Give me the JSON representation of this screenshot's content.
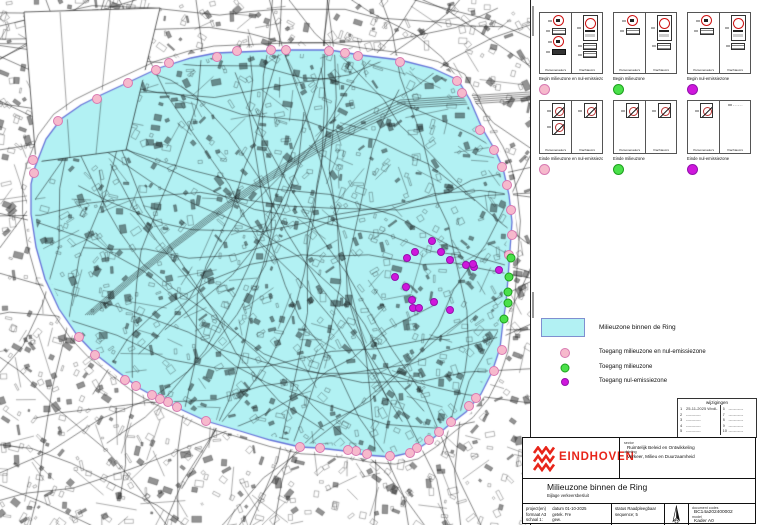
{
  "colors": {
    "zone_fill": "#b2f1f3",
    "zone_border": "#6673d9",
    "pink_fill": "#f6b9cc",
    "pink_stroke": "#d87ab2",
    "green_fill": "#4ae04a",
    "green_stroke": "#1da01d",
    "magenta_fill": "#cf17dc",
    "magenta_stroke": "#9311ad",
    "brand_red": "#e8251a"
  },
  "map": {
    "zone_polygon": [
      [
        240,
        52
      ],
      [
        290,
        50
      ],
      [
        330,
        50
      ],
      [
        360,
        55
      ],
      [
        400,
        60
      ],
      [
        432,
        68
      ],
      [
        458,
        80
      ],
      [
        470,
        100
      ],
      [
        482,
        128
      ],
      [
        495,
        150
      ],
      [
        503,
        168
      ],
      [
        509,
        195
      ],
      [
        512,
        222
      ],
      [
        510,
        250
      ],
      [
        508,
        278
      ],
      [
        506,
        303
      ],
      [
        503,
        322
      ],
      [
        500,
        348
      ],
      [
        492,
        372
      ],
      [
        481,
        394
      ],
      [
        466,
        412
      ],
      [
        449,
        425
      ],
      [
        431,
        440
      ],
      [
        413,
        452
      ],
      [
        391,
        457
      ],
      [
        366,
        455
      ],
      [
        345,
        451
      ],
      [
        319,
        448
      ],
      [
        300,
        447
      ],
      [
        270,
        440
      ],
      [
        240,
        431
      ],
      [
        206,
        421
      ],
      [
        178,
        408
      ],
      [
        159,
        399
      ],
      [
        139,
        388
      ],
      [
        117,
        371
      ],
      [
        94,
        353
      ],
      [
        77,
        335
      ],
      [
        59,
        309
      ],
      [
        45,
        279
      ],
      [
        36,
        247
      ],
      [
        31,
        214
      ],
      [
        31,
        184
      ],
      [
        35,
        167
      ],
      [
        46,
        139
      ],
      [
        61,
        119
      ],
      [
        81,
        105
      ],
      [
        101,
        95
      ],
      [
        129,
        82
      ],
      [
        159,
        68
      ],
      [
        191,
        58
      ],
      [
        216,
        53
      ]
    ],
    "access_points": {
      "pink": [
        [
          237,
          51
        ],
        [
          271,
          50
        ],
        [
          286,
          50
        ],
        [
          329,
          51
        ],
        [
          345,
          53
        ],
        [
          358,
          56
        ],
        [
          400,
          62
        ],
        [
          457,
          81
        ],
        [
          462,
          93
        ],
        [
          480,
          130
        ],
        [
          494,
          150
        ],
        [
          502,
          167
        ],
        [
          507,
          185
        ],
        [
          511,
          210
        ],
        [
          512,
          235
        ],
        [
          509,
          255
        ],
        [
          502,
          350
        ],
        [
          494,
          371
        ],
        [
          476,
          398
        ],
        [
          469,
          406
        ],
        [
          451,
          422
        ],
        [
          439,
          432
        ],
        [
          429,
          440
        ],
        [
          417,
          448
        ],
        [
          410,
          453
        ],
        [
          390,
          456
        ],
        [
          367,
          454
        ],
        [
          356,
          451
        ],
        [
          348,
          450
        ],
        [
          320,
          448
        ],
        [
          300,
          447
        ],
        [
          206,
          421
        ],
        [
          177,
          407
        ],
        [
          168,
          402
        ],
        [
          160,
          399
        ],
        [
          152,
          395
        ],
        [
          136,
          386
        ],
        [
          125,
          380
        ],
        [
          95,
          355
        ],
        [
          79,
          337
        ],
        [
          58,
          121
        ],
        [
          33,
          160
        ],
        [
          34,
          173
        ],
        [
          97,
          99
        ],
        [
          128,
          83
        ],
        [
          156,
          70
        ],
        [
          169,
          63
        ],
        [
          217,
          57
        ]
      ],
      "green": [
        [
          511,
          258
        ],
        [
          509,
          277
        ],
        [
          508,
          292
        ],
        [
          508,
          303
        ],
        [
          504,
          319
        ]
      ],
      "magenta": [
        [
          432,
          241
        ],
        [
          441,
          252
        ],
        [
          415,
          252
        ],
        [
          407,
          258
        ],
        [
          450,
          260
        ],
        [
          466,
          265
        ],
        [
          474,
          267
        ],
        [
          395,
          277
        ],
        [
          406,
          287
        ],
        [
          412,
          300
        ],
        [
          413,
          308
        ],
        [
          419,
          308
        ],
        [
          434,
          302
        ],
        [
          450,
          310
        ],
        [
          499,
          270
        ],
        [
          473,
          264
        ]
      ]
    }
  },
  "signs": {
    "rows": [
      {
        "boxes": [
          {
            "caption": "Begin milieuzone en nul-emissiezone",
            "dot": "pink",
            "cells": [
              {
                "caption": "Personenauto's",
                "glyphs": [
                  "circle",
                  "plaque",
                  "circle",
                  "plaque-dark"
                ]
              },
              {
                "caption": "Vrachtauto's",
                "glyphs": [
                  "zone",
                  "plaque",
                  "plaque"
                ]
              }
            ]
          },
          {
            "caption": "Begin milieuzone",
            "dot": "green",
            "cells": [
              {
                "caption": "Personenauto's",
                "glyphs": [
                  "circle",
                  "plaque"
                ]
              },
              {
                "caption": "Vrachtauto's",
                "glyphs": [
                  "zone",
                  "plaque"
                ]
              }
            ]
          },
          {
            "caption": "Begin nul-emissiezone",
            "dot": "magenta",
            "cells": [
              {
                "caption": "Personenauto's",
                "glyphs": [
                  "circle",
                  "plaque"
                ]
              },
              {
                "caption": "Vrachtauto's",
                "glyphs": [
                  "zone",
                  "plaque"
                ]
              }
            ]
          }
        ]
      },
      {
        "boxes": [
          {
            "caption": "Einde milieuzone en nul-emissiezone",
            "dot": "pink",
            "cells": [
              {
                "caption": "Personenauto's",
                "glyphs": [
                  "slash",
                  "slash"
                ]
              },
              {
                "caption": "Vrachtauto's",
                "glyphs": [
                  "slash"
                ]
              }
            ]
          },
          {
            "caption": "Einde milieuzone",
            "dot": "green",
            "cells": [
              {
                "caption": "Personenauto's",
                "glyphs": [
                  "slash"
                ]
              },
              {
                "caption": "Vrachtauto's",
                "glyphs": [
                  "slash"
                ]
              }
            ]
          },
          {
            "caption": "Einde nul-emissiezone",
            "dot": "magenta",
            "cells": [
              {
                "caption": "Personenauto's",
                "glyphs": [
                  "slash"
                ]
              },
              {
                "caption": "Vrachtauto's",
                "glyphs": [
                  "dash"
                ]
              }
            ]
          }
        ]
      }
    ]
  },
  "legend": {
    "zone_label": "Milieuzone binnen de Ring",
    "items": [
      {
        "color": "pink",
        "label": "Toegang milieuzone en nul-emissiezone"
      },
      {
        "color": "green",
        "label": "Toegang milieuzone"
      },
      {
        "color": "magenta",
        "label": "Toegang nul-emissiezone"
      }
    ]
  },
  "revisions": {
    "title": "wijzigingen",
    "left": [
      {
        "n": "1",
        "text": "25-11-2025   WvdL"
      },
      {
        "n": "2",
        "text": "-----------"
      },
      {
        "n": "3",
        "text": "-----------"
      },
      {
        "n": "4",
        "text": "-----------"
      },
      {
        "n": "5",
        "text": "-----------"
      }
    ],
    "right": [
      {
        "n": "6",
        "text": "-----------"
      },
      {
        "n": "7",
        "text": "-----------"
      },
      {
        "n": "8",
        "text": "-----------"
      },
      {
        "n": "9",
        "text": "-----------"
      },
      {
        "n": "10",
        "text": "-----------"
      }
    ]
  },
  "title_block": {
    "logo_text": "EINDHOVEN",
    "sector_label": "sector",
    "sector_value": "Ruimtelijk Beleid en Ontwikkeling",
    "afdeling_label": "afdeling",
    "afdeling_value": "Verkeer, Milieu en Duurzaamheid",
    "title": "Milieuzone binnen de Ring",
    "subtitle": "Bijlage verkeersbesluit",
    "col1_left": [
      "project(en)",
      "formaat   A3",
      "schaal   1:"
    ],
    "col1_right": [
      "datum   01-10-2025",
      "getek.   Fre",
      "gew."
    ],
    "status_line": "status   Raadpleegbaar",
    "sequence_line": "sequence;   5",
    "doc_label": "document codes",
    "doc_value": "BC14a202400002",
    "model_label": "model",
    "model_value": "Kader A0"
  }
}
